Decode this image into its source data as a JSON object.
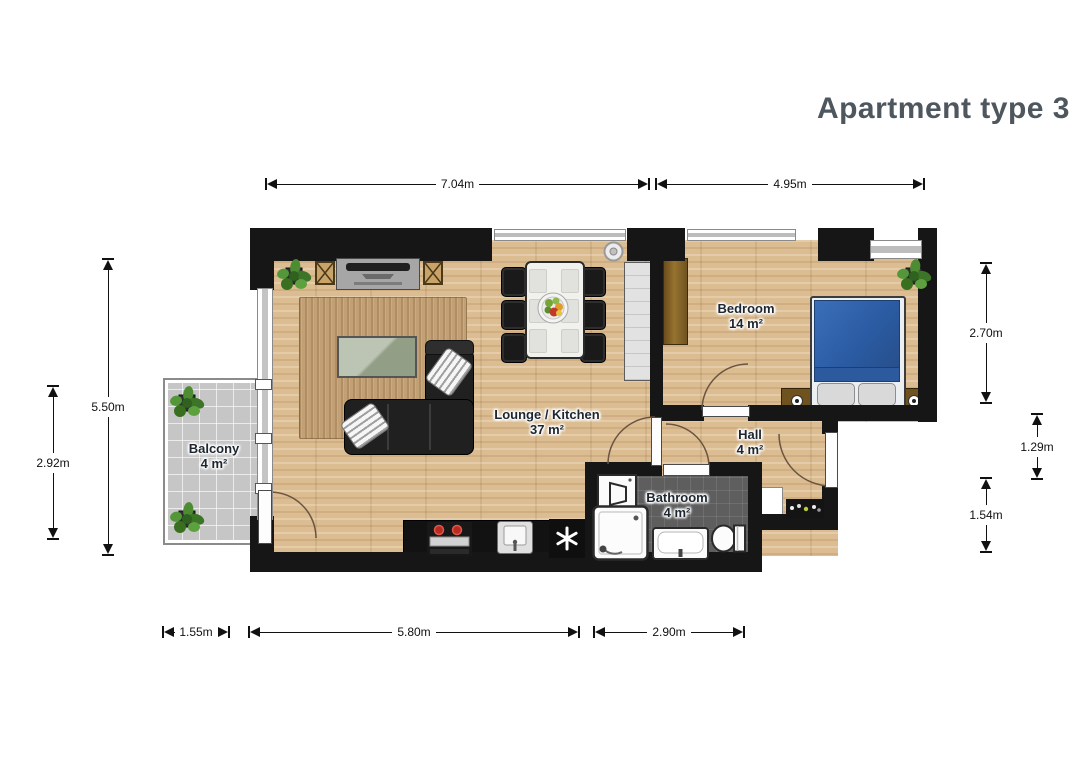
{
  "title": "Apartment type 3",
  "rooms": {
    "balcony": {
      "name": "Balcony",
      "area": "4 m²"
    },
    "lounge": {
      "name": "Lounge / Kitchen",
      "area": "37 m²"
    },
    "bedroom": {
      "name": "Bedroom",
      "area": "14 m²"
    },
    "hall": {
      "name": "Hall",
      "area": "4 m²"
    },
    "bathroom": {
      "name": "Bathroom",
      "area": "4 m²"
    }
  },
  "dimensions": {
    "top": [
      "7.04m",
      "4.95m"
    ],
    "bottom": [
      "1.55m",
      "5.80m",
      "2.90m"
    ],
    "left": [
      "5.50m",
      "2.92m"
    ],
    "right": [
      "2.70m",
      "1.29m",
      "1.54m"
    ]
  },
  "furniture": {
    "lounge": [
      "corner-sofa",
      "rug",
      "coffee-table",
      "tv-sideboard",
      "end-table",
      "end-table",
      "dining-table",
      "six-chairs",
      "fruit-bowl",
      "kitchen-counter",
      "stove",
      "kitchen-sink",
      "freezer-unit",
      "potted-plant",
      "ceiling-light"
    ],
    "bedroom": [
      "double-bed",
      "nightstand",
      "nightstand",
      "wardrobe",
      "potted-plant"
    ],
    "bathroom": [
      "washing-machine",
      "shower",
      "washbasin",
      "toilet"
    ],
    "hall": [
      "shoe-rack",
      "cabinet"
    ],
    "balcony": [
      "potted-plant",
      "potted-plant"
    ]
  },
  "colors": {
    "title_text": "#4e565e",
    "wall": "#161616",
    "wood_floor": "#dcbd92",
    "bathroom_floor": "#5e5e5e",
    "balcony_floor": "#c6c6c6",
    "bed_blue": "#2b5ca4",
    "rug_tan": "#c2a075",
    "sofa_black": "#202020",
    "coffee_table_green": "#9fab92",
    "dimension_line": "#111111"
  }
}
